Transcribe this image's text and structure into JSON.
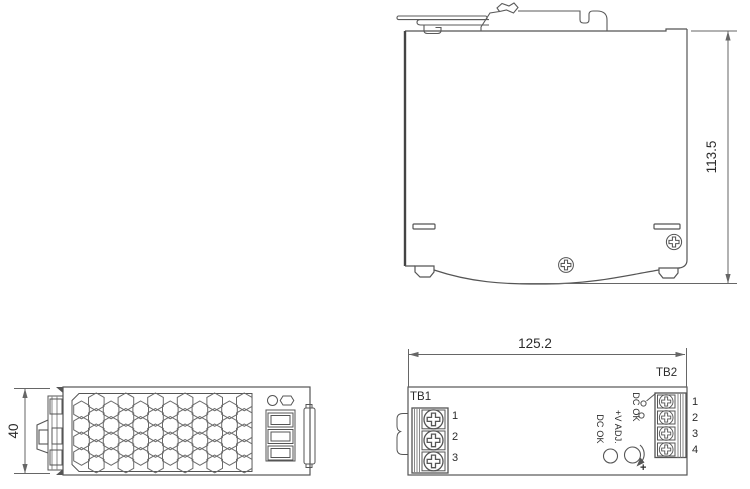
{
  "drawing": {
    "side_view": {
      "height_dim": "113.5"
    },
    "end_view": {
      "width_dim": "40"
    },
    "front_view": {
      "width_dim": "125.2",
      "tb1_label": "TB1",
      "tb1_pins": [
        "1",
        "2",
        "3"
      ],
      "tb2_label": "TB2",
      "tb2_pins": [
        "1",
        "2",
        "3",
        "4"
      ],
      "dc_ok_contact_label": "DC OK",
      "v_adj_label": "+V ADJ.",
      "dc_ok_led_label": "DC OK",
      "plus_label": "+"
    }
  }
}
